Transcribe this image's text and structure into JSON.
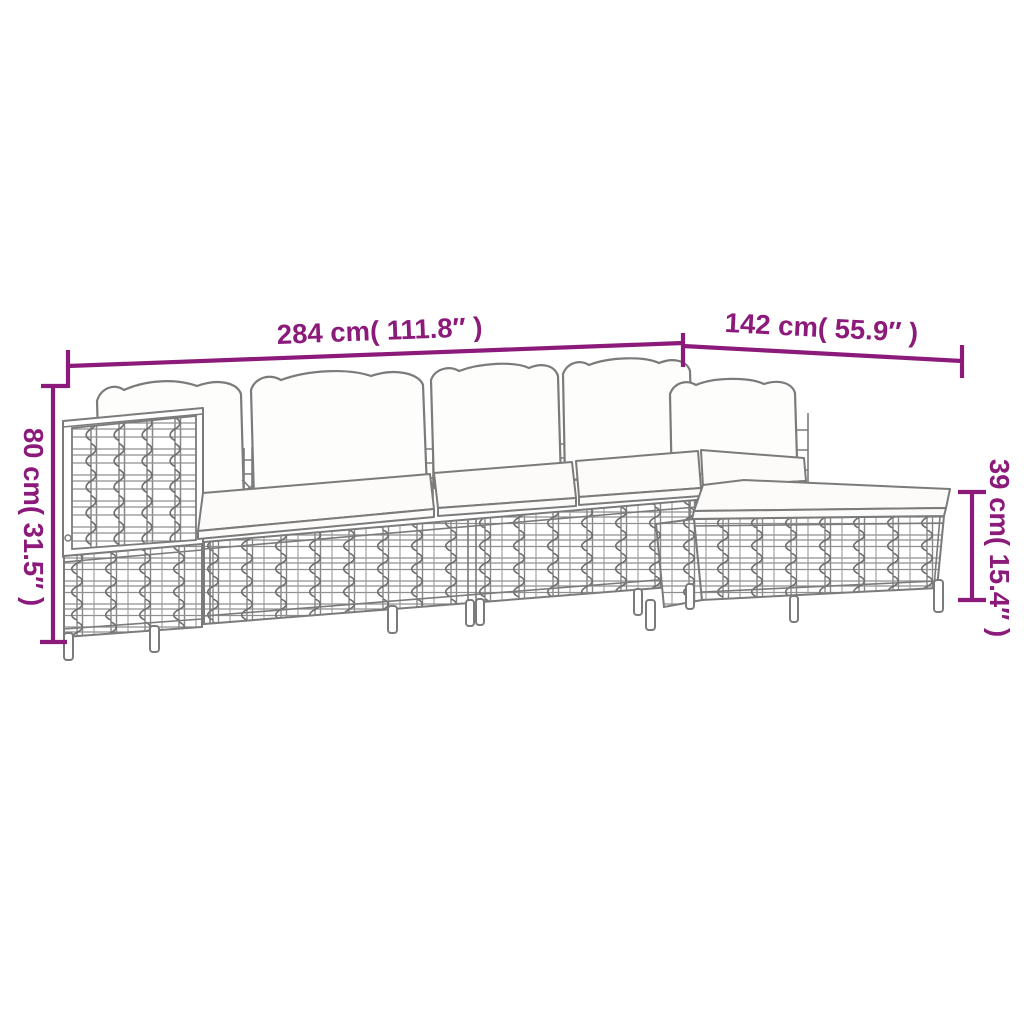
{
  "page": {
    "background": "#FFFFFF"
  },
  "diagram": {
    "subject": "sectional-garden-sofa-with-footstool-line-drawing",
    "style": "product dimension drawing",
    "colors": {
      "dimension_accent": "#8B1A7B",
      "drawing_outline": "#7B7B7B",
      "background": "#FFFFFF"
    },
    "dimensions": [
      {
        "id": "overall-width",
        "label": "284 cm( 111.8″ )",
        "orientation": "horizontal",
        "position": "top-left"
      },
      {
        "id": "side-depth",
        "label": "142 cm( 55.9″ )",
        "orientation": "horizontal",
        "position": "top-right"
      },
      {
        "id": "back-height",
        "label": "80 cm( 31.5″ )",
        "orientation": "vertical",
        "position": "left"
      },
      {
        "id": "seat-height",
        "label": "39 cm( 15.4″ )",
        "orientation": "vertical",
        "position": "right"
      }
    ]
  }
}
